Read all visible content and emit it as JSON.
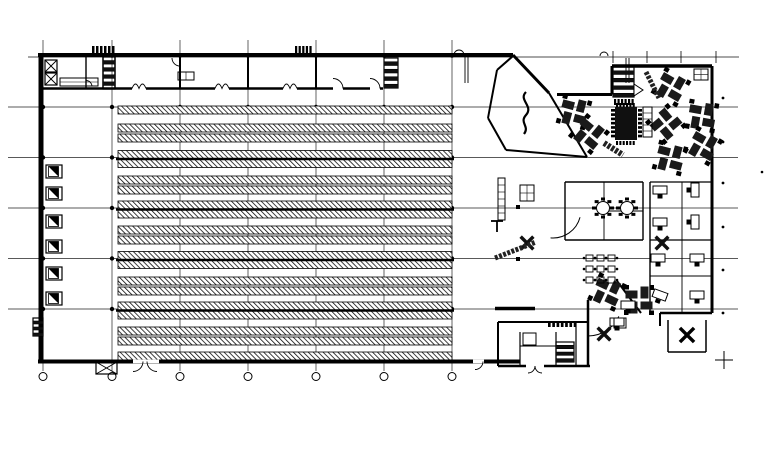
{
  "meta": {
    "width": 774,
    "height": 453,
    "bg": "#ffffff",
    "ink": "#000000",
    "label": "warehouse-and-office-floor-plan"
  },
  "grid": {
    "v_xs": [
      43,
      112,
      180,
      248,
      316,
      384,
      452
    ],
    "v_y1": 40,
    "v_y2": 371,
    "h_ys": [
      107,
      157.5,
      208,
      258.5,
      309
    ],
    "h_x1": 8,
    "h_x2": 738,
    "top_line": {
      "y": 57,
      "x1": 28,
      "x2": 739
    },
    "top_ticks": {
      "y": 57,
      "xs": [
        613,
        647,
        681,
        716
      ],
      "len": 6
    },
    "bubble": {
      "y": 376.5,
      "r": 4
    },
    "dot_r": 2.2,
    "wall_dot_xs": [
      112,
      180,
      248,
      316,
      384,
      452
    ],
    "right_dots": {
      "x": 723,
      "ys": [
        98,
        142,
        183,
        227,
        270,
        313
      ],
      "r": 1.4
    },
    "lone_dot": {
      "x": 762,
      "y": 172
    },
    "crosshair": {
      "x": 724,
      "y": 360,
      "arm": 9
    }
  },
  "racks": {
    "x1": 118,
    "x2": 452,
    "band_h": 8,
    "rows_y": [
      106,
      124,
      134,
      150.5,
      159.5,
      176,
      186,
      201,
      210,
      226,
      236,
      251.5,
      260.5,
      277,
      287,
      302,
      311,
      327,
      337,
      352
    ],
    "heavy_ys": [
      159,
      209.5,
      260,
      310.5
    ],
    "heavy_x1": 116,
    "heavy_x2": 454,
    "heavy_w": 2.4
  },
  "walls": {
    "segments": [
      [
        38,
        55,
        513,
        55,
        4
      ],
      [
        41,
        53,
        41,
        363,
        5
      ],
      [
        38,
        361.5,
        520,
        361.5,
        4
      ],
      [
        41,
        88.5,
        383,
        88.5,
        2.5
      ],
      [
        86,
        57,
        86,
        88.5,
        1.4
      ],
      [
        103,
        57,
        103,
        88.5,
        1.4
      ],
      [
        115,
        57,
        115,
        88.5,
        1.4
      ],
      [
        180,
        55,
        180,
        88.5,
        2
      ],
      [
        248,
        55,
        248,
        88.5,
        2
      ],
      [
        316,
        55,
        316,
        88.5,
        2
      ],
      [
        465,
        57,
        465,
        83,
        0.9
      ],
      [
        468,
        57,
        468,
        83,
        0.9
      ],
      [
        626,
        58,
        626,
        83,
        0.9
      ],
      [
        629,
        58,
        629,
        83,
        0.9
      ],
      [
        513,
        55,
        549,
        93,
        3
      ],
      [
        557,
        94.5,
        612,
        94.5,
        3
      ],
      [
        612,
        66,
        612,
        94.5,
        3
      ],
      [
        612,
        66,
        712,
        66,
        3.5
      ],
      [
        712,
        66,
        712,
        313,
        3
      ],
      [
        712,
        313,
        660,
        313,
        2.5
      ],
      [
        660,
        313,
        660,
        326,
        2
      ],
      [
        668,
        320,
        668,
        352,
        1.5
      ],
      [
        668,
        352,
        706,
        352,
        1.5
      ],
      [
        706,
        320,
        706,
        352,
        1.5
      ],
      [
        498,
        322,
        588,
        322,
        2
      ],
      [
        498,
        322,
        498,
        366,
        2
      ],
      [
        498,
        366,
        590,
        366,
        2.5
      ],
      [
        520,
        332,
        520,
        366,
        1.2
      ],
      [
        520,
        346,
        556,
        346,
        1
      ],
      [
        556,
        332,
        556,
        366,
        1.2
      ],
      [
        576,
        322,
        576,
        366,
        1.2
      ],
      [
        588,
        300,
        588,
        367,
        2.5
      ],
      [
        497,
        70,
        513,
        56,
        2
      ],
      [
        488,
        118,
        497,
        70,
        2
      ],
      [
        488,
        118,
        506,
        150,
        2
      ],
      [
        506,
        150,
        587,
        157,
        2
      ],
      [
        549,
        93,
        587,
        157,
        2
      ],
      [
        565,
        182,
        643,
        182,
        1.4
      ],
      [
        565,
        182,
        565,
        240,
        1.4
      ],
      [
        643,
        182,
        643,
        240,
        1.4
      ],
      [
        565,
        240,
        643,
        240,
        1.4
      ],
      [
        604,
        182,
        604,
        240,
        0.9
      ],
      [
        604,
        211,
        643,
        211,
        0.9
      ],
      [
        650,
        182,
        712,
        182,
        1.2
      ],
      [
        650,
        182,
        650,
        313,
        1.4
      ],
      [
        682,
        182,
        682,
        240,
        0.9
      ],
      [
        650,
        240,
        712,
        240,
        1.2
      ],
      [
        650,
        276,
        712,
        276,
        0.9
      ],
      [
        682,
        240,
        682,
        313,
        0.9
      ],
      [
        617,
        281,
        641,
        313,
        2
      ],
      [
        495,
        308.5,
        535,
        308.5,
        3.5
      ],
      [
        60,
        82,
        98,
        82,
        0.6
      ],
      [
        491,
        221,
        503,
        221,
        1.8
      ],
      [
        497,
        221,
        497,
        232,
        1.8
      ]
    ],
    "whitewash": [
      [
        333,
        86.8,
        10,
        3.4
      ],
      [
        370,
        86.8,
        10,
        3.4
      ],
      [
        133,
        359.6,
        26,
        3.6
      ],
      [
        473,
        359.6,
        11,
        3.6
      ],
      [
        526,
        364.2,
        18,
        3.4
      ]
    ],
    "arcs": [
      [
        333,
        88.5,
        10,
        270,
        360,
        0.9
      ],
      [
        370,
        88.5,
        10,
        270,
        360,
        0.9
      ],
      [
        86,
        86.5,
        6,
        270,
        360,
        0.9
      ],
      [
        180,
        58,
        8,
        90,
        180,
        0.9
      ],
      [
        459,
        55,
        5,
        180,
        360,
        0.9
      ],
      [
        604,
        56,
        4,
        180,
        360,
        0.9
      ],
      [
        553,
        210,
        28,
        15,
        95,
        1
      ],
      [
        588,
        302,
        34,
        25,
        90,
        1
      ],
      [
        133,
        361.5,
        10,
        0,
        90,
        0.9
      ],
      [
        157,
        361.5,
        10,
        90,
        180,
        0.9
      ],
      [
        475,
        361.5,
        8,
        0,
        90,
        0.9
      ],
      [
        528,
        366,
        7,
        0,
        90,
        0.9
      ],
      [
        542,
        366,
        7,
        90,
        180,
        0.9
      ]
    ],
    "m_doors": {
      "y": 88.5,
      "xs": [
        139,
        222,
        290
      ],
      "half": 7,
      "rise": 9
    },
    "squiggle": "M526,92 C518,100 534,106 526,115 C519,123 530,126 524,134"
  },
  "docks": {
    "x": 46,
    "w": 16,
    "h": 13,
    "inner_off": 2.5,
    "inner": 10,
    "ys": [
      165,
      187,
      215,
      240,
      267,
      292
    ],
    "stub_x": 38.5,
    "stub_w": 4,
    "stub_h": 3
  },
  "stairs": [
    [
      103,
      57,
      12,
      32,
      9
    ],
    [
      384,
      58,
      14,
      30,
      8
    ],
    [
      613,
      67,
      21,
      30,
      8
    ],
    [
      556,
      342,
      18,
      20,
      6
    ],
    [
      33,
      318,
      10,
      18,
      6
    ]
  ],
  "door_point": [
    [
      634,
      84
    ],
    [
      643,
      90
    ],
    [
      634,
      96
    ]
  ],
  "furniture": {
    "pinwheels": [
      [
        574,
        112,
        15
      ],
      [
        589,
        134,
        40
      ],
      [
        671,
        87,
        30
      ],
      [
        702,
        116,
        10
      ],
      [
        666,
        124,
        50
      ],
      [
        703,
        146,
        30
      ],
      [
        670,
        158,
        15
      ],
      [
        607,
        292,
        25
      ],
      [
        639,
        300,
        0
      ]
    ],
    "round_tables": [
      [
        603,
        208
      ],
      [
        627,
        208
      ]
    ],
    "x_tables": [
      [
        662,
        243
      ],
      [
        527,
        243
      ],
      [
        604,
        334
      ]
    ],
    "star": {
      "x": 687,
      "y": 335,
      "len": 10,
      "w": 3.5
    },
    "desks": [
      [
        660,
        190,
        0
      ],
      [
        695,
        190,
        90
      ],
      [
        660,
        222,
        0
      ],
      [
        695,
        222,
        90
      ],
      [
        658,
        258,
        0
      ],
      [
        697,
        258,
        0
      ],
      [
        660,
        295,
        20
      ],
      [
        697,
        295,
        0
      ],
      [
        617,
        322,
        0
      ],
      [
        628,
        305,
        0
      ]
    ],
    "diag_bars": [
      [
        495,
        258,
        536,
        242,
        5
      ],
      [
        646,
        72,
        659,
        98,
        5
      ],
      [
        604,
        143,
        623,
        155,
        6
      ]
    ],
    "grid_rects": [
      [
        498,
        178,
        7,
        42,
        1,
        6
      ],
      [
        520,
        185,
        14,
        16,
        2,
        2
      ],
      [
        643,
        107,
        9,
        30,
        1,
        5
      ],
      [
        694,
        69,
        14,
        11,
        2,
        2
      ],
      [
        178,
        72,
        16,
        8,
        2,
        1
      ],
      [
        614,
        318,
        12,
        10,
        1,
        1
      ],
      [
        523,
        333,
        13,
        12,
        1,
        1
      ]
    ],
    "x_boxes": [
      [
        45,
        60,
        12,
        12
      ],
      [
        45,
        73,
        12,
        12
      ],
      [
        96,
        362,
        21,
        12
      ]
    ],
    "plain_rects": [
      [
        60,
        78,
        38,
        8
      ]
    ],
    "big_table": {
      "x": 615,
      "y": 107,
      "w": 22,
      "h": 33
    },
    "combs": [
      [
        92,
        46,
        24,
        7,
        6,
        "h"
      ],
      [
        295,
        46,
        18,
        7,
        5,
        "h"
      ],
      [
        548,
        321,
        30,
        6,
        7,
        "h"
      ],
      [
        614,
        99,
        21,
        6,
        6,
        "h"
      ],
      [
        611,
        109,
        4,
        30,
        7,
        "v"
      ],
      [
        638,
        109,
        4,
        30,
        7,
        "v"
      ],
      [
        616,
        103,
        20,
        4,
        6,
        "h"
      ],
      [
        616,
        141,
        20,
        4,
        6,
        "h"
      ]
    ],
    "cafe": {
      "x0": 586,
      "y0": 255,
      "cols": 3,
      "rows": 3,
      "dx": 11,
      "dy": 11,
      "w": 7,
      "h": 6
    },
    "black_squares": [
      [
        518,
        207
      ],
      [
        518,
        259
      ]
    ]
  }
}
